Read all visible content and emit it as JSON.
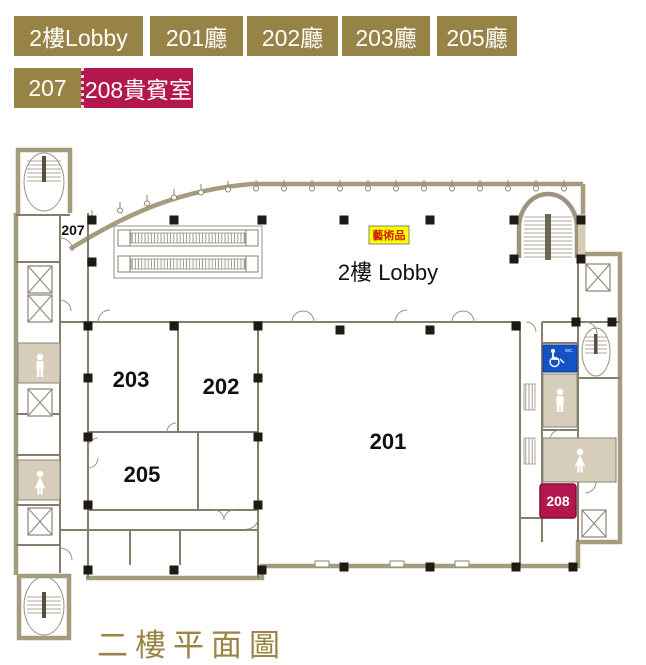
{
  "tabs": {
    "row1": [
      {
        "label": "2樓Lobby"
      },
      {
        "label": "201廳"
      },
      {
        "label": "202廳"
      },
      {
        "label": "203廳"
      },
      {
        "label": "205廳"
      }
    ],
    "row2": [
      {
        "label": "207"
      },
      {
        "label": "208貴賓室",
        "active": true
      }
    ],
    "colors": {
      "default_bg": "#988347",
      "active_bg": "#B3174E",
      "text": "#FFFFFF"
    }
  },
  "floor_plan": {
    "labels": {
      "lobby": "2樓 Lobby",
      "artwork": "藝術品",
      "room_207": "207",
      "room_203": "203",
      "room_202": "202",
      "room_205": "205",
      "room_201": "201",
      "room_208": "208",
      "accessible_wc": "WC"
    },
    "colors": {
      "wall": "#8A8374",
      "wall_exterior": "#A59C7F",
      "column": "#1F1B14",
      "restroom_fill": "#D6CEBB",
      "accessible_blue": "#1452C8",
      "artwork_bg": "#FFFF00",
      "artwork_text": "#CC2200",
      "badge_208_bg": "#B3174E"
    }
  },
  "title": {
    "text": "二樓平面圖",
    "color": "#9A8544"
  }
}
